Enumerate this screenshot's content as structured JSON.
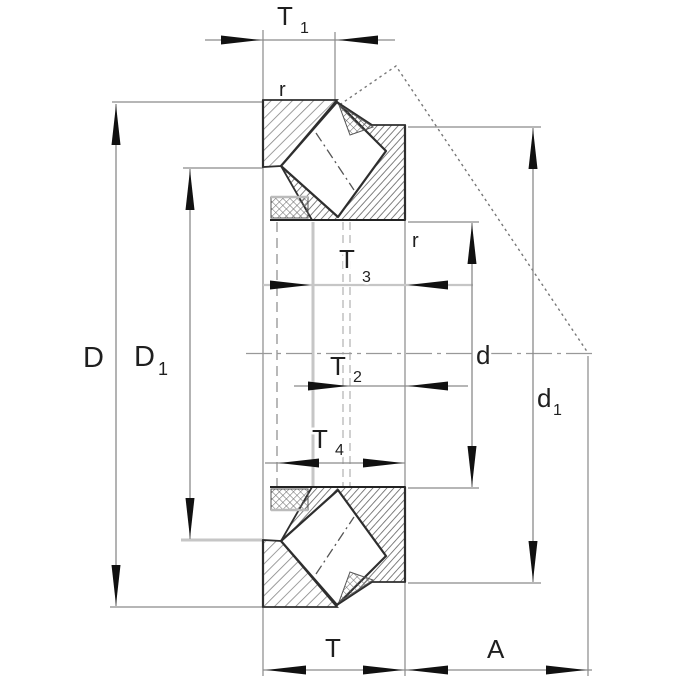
{
  "drawing": {
    "type": "bearing-dimension-cross-section",
    "labels": {
      "t1": {
        "main": "T",
        "sub": "1"
      },
      "t3": {
        "main": "T",
        "sub": "3"
      },
      "t2": {
        "main": "T",
        "sub": "2"
      },
      "t4": {
        "main": "T",
        "sub": "4"
      },
      "t": {
        "main": "T"
      },
      "a": {
        "main": "A"
      },
      "D": {
        "main": "D"
      },
      "D1": {
        "main": "D",
        "sub": "1"
      },
      "d": {
        "main": "d"
      },
      "d1": {
        "main": "d",
        "sub": "1"
      },
      "r_top": "r",
      "r_mid": "r"
    },
    "colors": {
      "background": "#ffffff",
      "outline": "#2e2e2e",
      "hatch_shaft_washer": "#858585",
      "hatch_housing_washer": "#737373",
      "hatch_cage": "#6a6a6a",
      "dimension_line": "#8a8a8a",
      "highlight_extension_line": "#c6c6c6",
      "centerline": "#999999",
      "load_line": "#777777",
      "arrow": "#111111",
      "text": "#1f1f1f"
    }
  }
}
